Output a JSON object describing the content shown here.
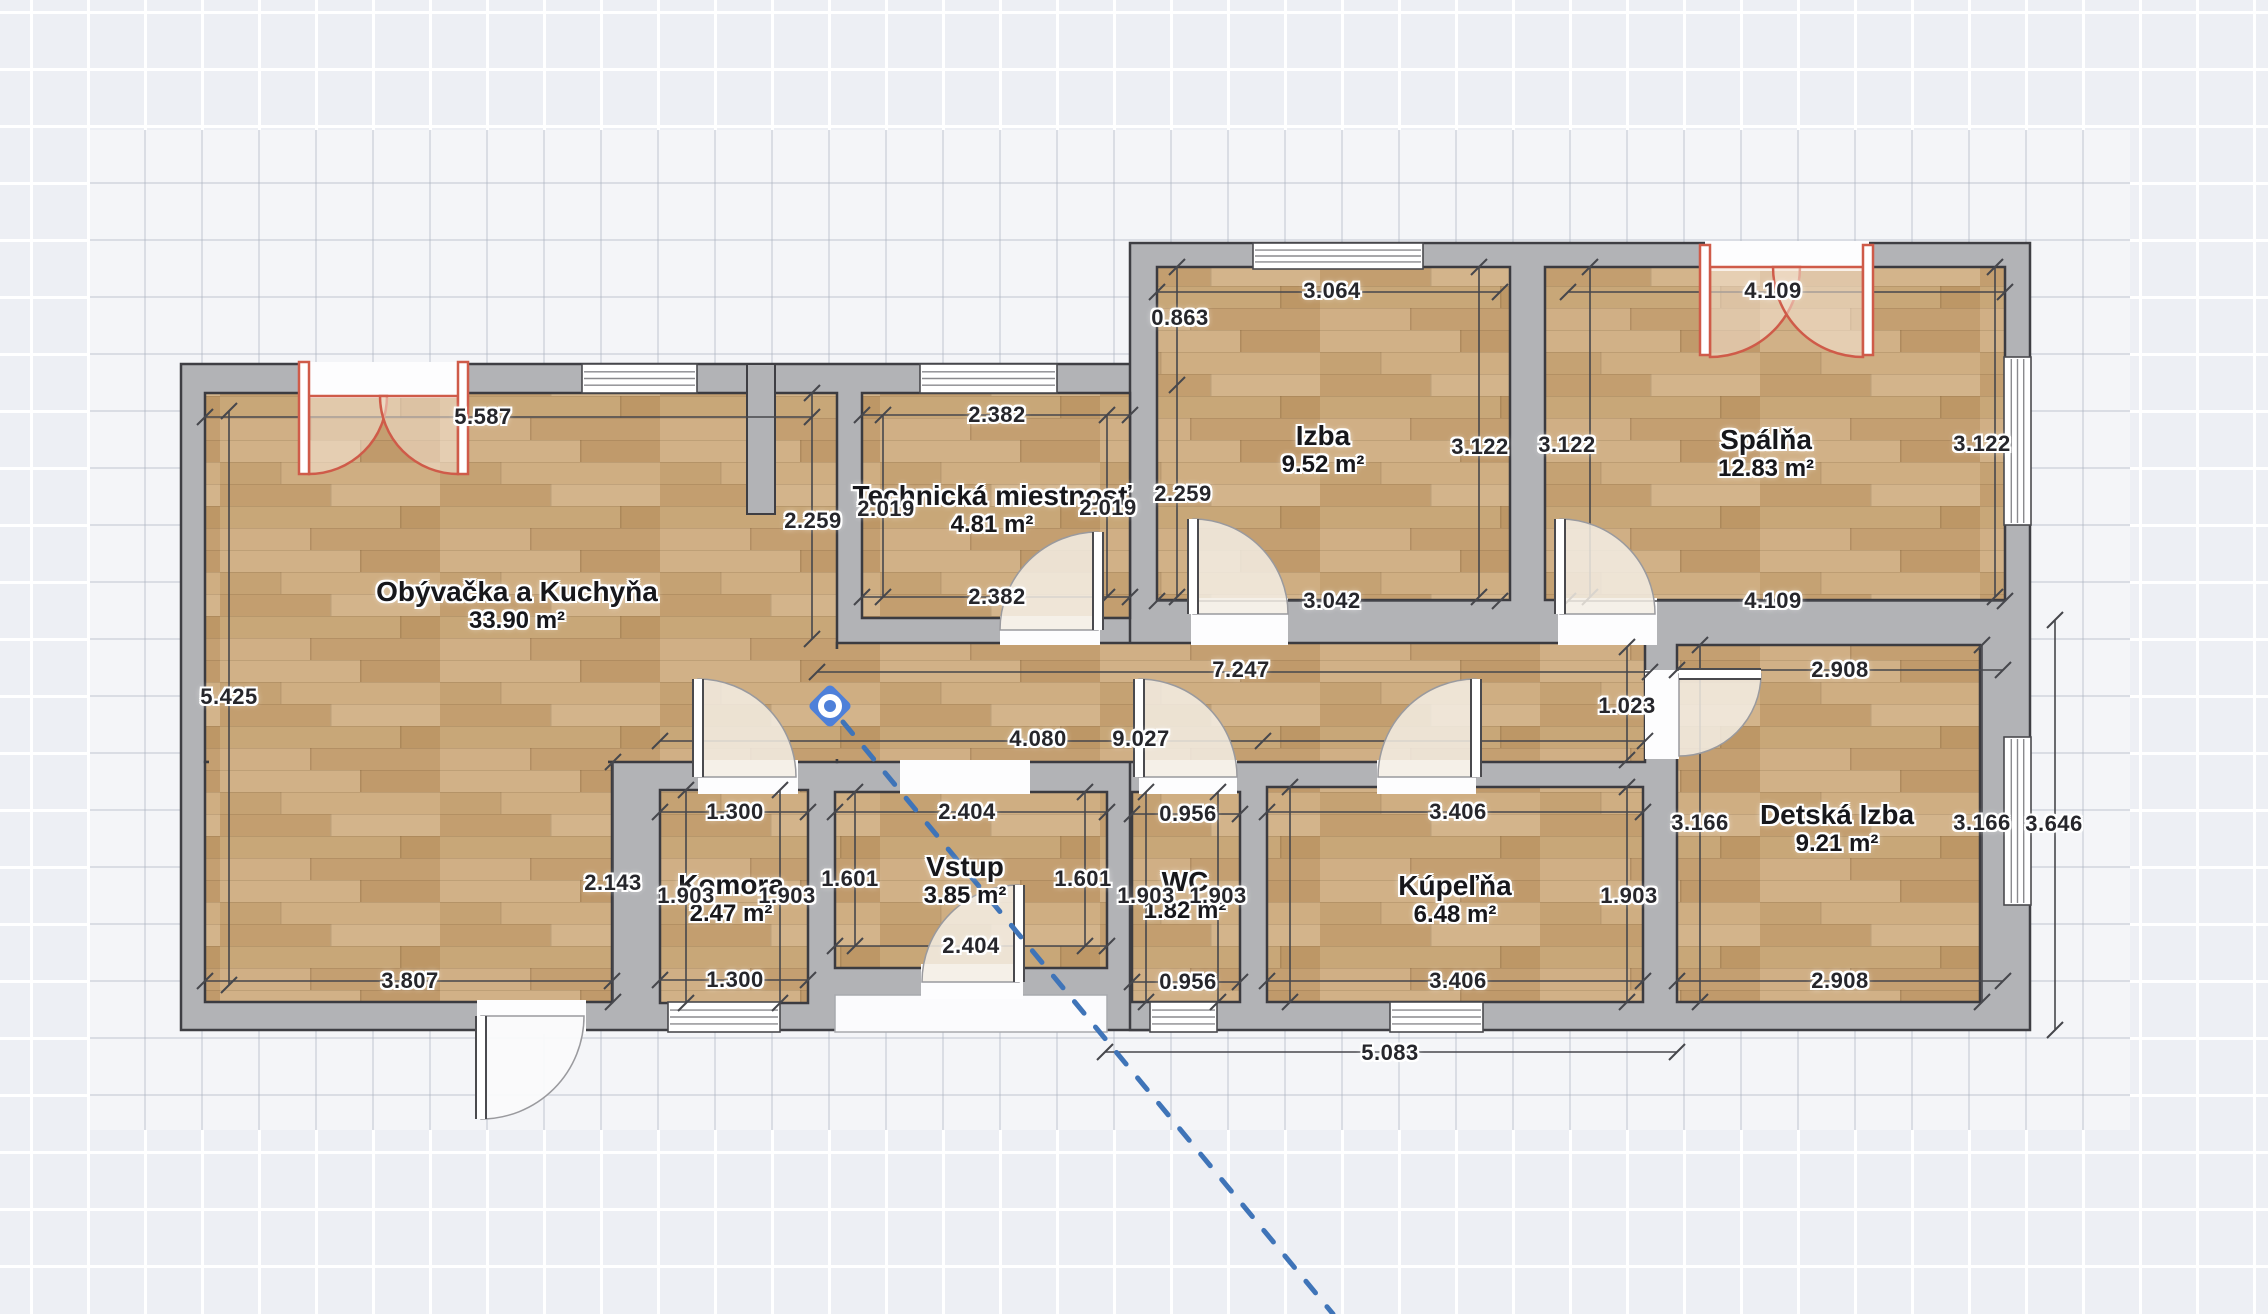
{
  "editor": {
    "selected_marker": "camera-viewpoint"
  },
  "colors": {
    "wall_fill": "#b2b3b6",
    "wall_edge": "#3e3e43",
    "floor_edge": "#3b3b40",
    "wood_base": "#c9a87b",
    "wood_planks": [
      "#d1b187",
      "#c09a6b",
      "#c5a273",
      "#cfae82",
      "#c39e6f",
      "#d3b48b",
      "#c8a778",
      "#bd9766",
      "#d0af85",
      "#c49f71"
    ],
    "dim_line": "#46474c",
    "red_door": "#cf5b49",
    "red_door_fill": "rgba(246,230,213,0.55)",
    "swing_fill": "rgba(243,237,228,0.85)",
    "ext_swing_fill": "rgba(250,250,251,0.95)",
    "dashed_line_blue": "#3f74b8",
    "opening_fill": "#fdfdfe",
    "porch_fill": "#fbfbfd",
    "porch_edge": "#a8a9ad",
    "camera_blue": "#4e80d9"
  },
  "rooms": [
    {
      "name": "Obývačka a Kuchyňa",
      "area": "33.90 m²",
      "label": [
        517,
        592
      ]
    },
    {
      "name": "Technická miestnosť",
      "area": "4.81 m²",
      "label": [
        992,
        496
      ]
    },
    {
      "name": "Izba",
      "area": "9.52 m²",
      "label": [
        1323,
        436
      ]
    },
    {
      "name": "Spálňa",
      "area": "12.83 m²",
      "label": [
        1766,
        440
      ]
    },
    {
      "name": "Komora",
      "area": "2.47 m²",
      "label": [
        731,
        885
      ]
    },
    {
      "name": "Vstup",
      "area": "3.85 m²",
      "label": [
        965,
        867
      ]
    },
    {
      "name": "WC",
      "area": "1.82 m²",
      "label": [
        1185,
        882
      ]
    },
    {
      "name": "Kúpeľňa",
      "area": "6.48 m²",
      "label": [
        1455,
        886
      ]
    },
    {
      "name": "Detská Izba",
      "area": "9.21 m²",
      "label": [
        1837,
        815
      ]
    }
  ],
  "walls": [
    {
      "id": "slab-left",
      "rect": [
        181,
        364,
        976,
        666
      ]
    },
    {
      "id": "slab-right",
      "rect": [
        1130,
        243,
        900,
        787
      ]
    }
  ],
  "wall_stub": [
    747,
    364,
    28,
    150
  ],
  "porch": [
    835,
    995,
    272,
    37
  ],
  "floors": [
    {
      "room": 0,
      "rect": [
        205,
        393,
        632,
        369
      ]
    },
    {
      "room": 0,
      "rect": [
        205,
        762,
        407,
        240
      ]
    },
    {
      "room": 0,
      "rect": [
        837,
        643,
        808,
        119
      ],
      "id": "corridor"
    },
    {
      "room": 1,
      "rect": [
        862,
        393,
        268,
        225
      ]
    },
    {
      "room": 2,
      "rect": [
        1157,
        267,
        353,
        333
      ]
    },
    {
      "room": 3,
      "rect": [
        1545,
        267,
        460,
        333
      ]
    },
    {
      "room": 8,
      "rect": [
        1677,
        645,
        303,
        357
      ]
    },
    {
      "room": 4,
      "rect": [
        660,
        790,
        148,
        213
      ]
    },
    {
      "room": 5,
      "rect": [
        835,
        792,
        272,
        176
      ]
    },
    {
      "room": 6,
      "rect": [
        1132,
        792,
        108,
        210
      ]
    },
    {
      "room": 7,
      "rect": [
        1267,
        787,
        376,
        215
      ]
    }
  ],
  "floor_patches": [
    [
      209,
      756,
      399,
      12
    ],
    [
      831,
      649,
      12,
      110
    ]
  ],
  "openings": [
    [
      698,
      760,
      100,
      34
    ],
    [
      900,
      760,
      130,
      34
    ],
    [
      1139,
      760,
      98,
      34
    ],
    [
      1377,
      760,
      99,
      34
    ],
    [
      1000,
      616,
      100,
      29
    ],
    [
      1191,
      598,
      97,
      47
    ],
    [
      1558,
      598,
      99,
      47
    ],
    [
      1645,
      670,
      34,
      89
    ],
    [
      921,
      964,
      102,
      35
    ],
    [
      477,
      1000,
      109,
      34
    ],
    [
      300,
      362,
      168,
      36
    ],
    [
      1705,
      241,
      164,
      30
    ]
  ],
  "windows": [
    {
      "id": "living-top",
      "rect": [
        582,
        364,
        115,
        29
      ],
      "v": false
    },
    {
      "id": "technical-top",
      "rect": [
        920,
        364,
        137,
        29
      ],
      "v": false
    },
    {
      "id": "izba-top",
      "rect": [
        1253,
        243,
        170,
        26
      ],
      "v": false
    },
    {
      "id": "spalna-right",
      "rect": [
        2004,
        357,
        27,
        168
      ],
      "v": true
    },
    {
      "id": "detska-right",
      "rect": [
        2004,
        737,
        27,
        168
      ],
      "v": true
    },
    {
      "id": "komora-bottom",
      "rect": [
        668,
        1002,
        112,
        30
      ],
      "v": false
    },
    {
      "id": "wc-bottom",
      "rect": [
        1150,
        1002,
        67,
        30
      ],
      "v": false
    },
    {
      "id": "kupelna-bottom",
      "rect": [
        1390,
        1002,
        93,
        30
      ],
      "v": false
    }
  ],
  "doors": [
    {
      "id": "door-komora",
      "hinge": [
        698,
        777
      ],
      "tip": [
        698,
        679
      ],
      "end": [
        796,
        777
      ],
      "r": 98,
      "sweep": 1,
      "ext": false
    },
    {
      "id": "door-wc",
      "hinge": [
        1139,
        777
      ],
      "tip": [
        1139,
        679
      ],
      "end": [
        1237,
        777
      ],
      "r": 98,
      "sweep": 1,
      "ext": false
    },
    {
      "id": "door-kupelna",
      "hinge": [
        1476,
        777
      ],
      "tip": [
        1476,
        679
      ],
      "end": [
        1378,
        777
      ],
      "r": 98,
      "sweep": 0,
      "ext": false
    },
    {
      "id": "door-technical",
      "hinge": [
        1098,
        630
      ],
      "tip": [
        1098,
        532
      ],
      "end": [
        1000,
        630
      ],
      "r": 98,
      "sweep": 0,
      "ext": false
    },
    {
      "id": "door-izba",
      "hinge": [
        1193,
        614
      ],
      "tip": [
        1193,
        519
      ],
      "end": [
        1288,
        614
      ],
      "r": 95,
      "sweep": 1,
      "ext": false
    },
    {
      "id": "door-spalna",
      "hinge": [
        1560,
        614
      ],
      "tip": [
        1560,
        519
      ],
      "end": [
        1655,
        614
      ],
      "r": 95,
      "sweep": 1,
      "ext": false
    },
    {
      "id": "door-detska",
      "hinge": [
        1679,
        674
      ],
      "tip": [
        1761,
        674
      ],
      "end": [
        1679,
        756
      ],
      "r": 82,
      "sweep": 1,
      "ext": false
    },
    {
      "id": "door-entry",
      "hinge": [
        1019,
        982
      ],
      "tip": [
        1019,
        885
      ],
      "end": [
        922,
        982
      ],
      "r": 97,
      "sweep": 0,
      "ext": false
    },
    {
      "id": "door-exterior",
      "hinge": [
        481,
        1016
      ],
      "tip": [
        481,
        1119
      ],
      "end": [
        584,
        1016
      ],
      "r": 103,
      "sweep": 0,
      "ext": true
    }
  ],
  "french_doors": [
    {
      "id": "french-living",
      "leaves": [
        [
          299,
          362,
          10,
          112
        ],
        [
          458,
          362,
          10,
          112
        ]
      ],
      "arcs": [
        {
          "hinge": [
            309,
            396
          ],
          "tip": [
            309,
            474
          ],
          "end": [
            387,
            396
          ],
          "r": 78,
          "sweep": 0
        },
        {
          "hinge": [
            458,
            396
          ],
          "tip": [
            458,
            474
          ],
          "end": [
            380,
            396
          ],
          "r": 78,
          "sweep": 1
        }
      ]
    },
    {
      "id": "french-spalna",
      "leaves": [
        [
          1700,
          245,
          10,
          110
        ],
        [
          1863,
          245,
          10,
          110
        ]
      ],
      "arcs": [
        {
          "hinge": [
            1710,
            267
          ],
          "tip": [
            1710,
            357
          ],
          "end": [
            1800,
            267
          ],
          "r": 90,
          "sweep": 0
        },
        {
          "hinge": [
            1863,
            267
          ],
          "tip": [
            1863,
            357
          ],
          "end": [
            1773,
            267
          ],
          "r": 90,
          "sweep": 1
        }
      ]
    }
  ],
  "dim_lines": [
    [
      205,
      417,
      812,
      417
    ],
    [
      862,
      415,
      1130,
      415
    ],
    [
      1157,
      292,
      1500,
      292
    ],
    [
      1568,
      292,
      2005,
      292
    ],
    [
      862,
      597,
      1130,
      597
    ],
    [
      1157,
      601,
      1500,
      601
    ],
    [
      1568,
      601,
      2005,
      601
    ],
    [
      817,
      672,
      1650,
      672
    ],
    [
      1677,
      670,
      2003,
      670
    ],
    [
      660,
      741,
      1645,
      741
    ],
    [
      660,
      812,
      808,
      812
    ],
    [
      835,
      812,
      1107,
      812
    ],
    [
      1132,
      814,
      1240,
      814
    ],
    [
      1267,
      812,
      1643,
      812
    ],
    [
      835,
      946,
      1107,
      946
    ],
    [
      205,
      981,
      612,
      981
    ],
    [
      660,
      980,
      808,
      980
    ],
    [
      1132,
      982,
      1240,
      982
    ],
    [
      1267,
      981,
      1643,
      981
    ],
    [
      1677,
      981,
      2003,
      981
    ],
    [
      1105,
      1052,
      1677,
      1052
    ],
    [
      229,
      411,
      229,
      985
    ],
    [
      812,
      393,
      812,
      639
    ],
    [
      883,
      415,
      883,
      597
    ],
    [
      1107,
      415,
      1107,
      597
    ],
    [
      1177,
      267,
      1177,
      597
    ],
    [
      1479,
      267,
      1479,
      597
    ],
    [
      1590,
      267,
      1590,
      597
    ],
    [
      1995,
      267,
      1995,
      597
    ],
    [
      613,
      762,
      613,
      1002
    ],
    [
      686,
      790,
      686,
      1003
    ],
    [
      780,
      790,
      780,
      1003
    ],
    [
      855,
      792,
      855,
      946
    ],
    [
      1085,
      792,
      1085,
      946
    ],
    [
      1146,
      792,
      1146,
      1002
    ],
    [
      1218,
      792,
      1218,
      1002
    ],
    [
      1290,
      787,
      1290,
      1002
    ],
    [
      1627,
      647,
      1627,
      760
    ],
    [
      1627,
      787,
      1627,
      1002
    ],
    [
      1700,
      645,
      1700,
      1002
    ],
    [
      1982,
      645,
      1982,
      1002
    ],
    [
      2055,
      620,
      2055,
      1030
    ]
  ],
  "extra_ticks": [
    [
      1263,
      741
    ],
    [
      1177,
      385
    ]
  ],
  "dimensions": [
    {
      "text": "5.587",
      "pos": [
        483,
        417
      ]
    },
    {
      "text": "2.382",
      "pos": [
        997,
        415
      ]
    },
    {
      "text": "3.064",
      "pos": [
        1332,
        291
      ]
    },
    {
      "text": "4.109",
      "pos": [
        1773,
        291
      ]
    },
    {
      "text": "0.863",
      "pos": [
        1180,
        318
      ]
    },
    {
      "text": "2.259",
      "pos": [
        813,
        521
      ]
    },
    {
      "text": "2.019",
      "pos": [
        886,
        509
      ]
    },
    {
      "text": "2.019",
      "pos": [
        1108,
        508
      ]
    },
    {
      "text": "2.259",
      "pos": [
        1183,
        494
      ]
    },
    {
      "text": "3.122",
      "pos": [
        1480,
        447
      ]
    },
    {
      "text": "3.122",
      "pos": [
        1567,
        445
      ]
    },
    {
      "text": "3.122",
      "pos": [
        1982,
        444
      ]
    },
    {
      "text": "2.382",
      "pos": [
        997,
        597
      ]
    },
    {
      "text": "3.042",
      "pos": [
        1332,
        601
      ]
    },
    {
      "text": "4.109",
      "pos": [
        1773,
        601
      ]
    },
    {
      "text": "5.425",
      "pos": [
        229,
        697
      ]
    },
    {
      "text": "7.247",
      "pos": [
        1241,
        670
      ]
    },
    {
      "text": "2.908",
      "pos": [
        1840,
        670
      ]
    },
    {
      "text": "4.080",
      "pos": [
        1038,
        739
      ]
    },
    {
      "text": "9.027",
      "pos": [
        1141,
        739
      ]
    },
    {
      "text": "1.023",
      "pos": [
        1627,
        706
      ]
    },
    {
      "text": "1.300",
      "pos": [
        735,
        812
      ]
    },
    {
      "text": "2.404",
      "pos": [
        967,
        812
      ]
    },
    {
      "text": "0.956",
      "pos": [
        1188,
        814
      ]
    },
    {
      "text": "3.406",
      "pos": [
        1458,
        812
      ]
    },
    {
      "text": "3.166",
      "pos": [
        1700,
        823
      ]
    },
    {
      "text": "3.166",
      "pos": [
        1982,
        823
      ]
    },
    {
      "text": "3.646",
      "pos": [
        2054,
        824
      ]
    },
    {
      "text": "2.143",
      "pos": [
        613,
        883
      ]
    },
    {
      "text": "1.903",
      "pos": [
        686,
        896
      ]
    },
    {
      "text": "1.903",
      "pos": [
        787,
        896
      ]
    },
    {
      "text": "1.601",
      "pos": [
        850,
        879
      ]
    },
    {
      "text": "1.601",
      "pos": [
        1083,
        879
      ]
    },
    {
      "text": "1.903",
      "pos": [
        1146,
        896
      ]
    },
    {
      "text": "1.903",
      "pos": [
        1218,
        896
      ]
    },
    {
      "text": "1.903",
      "pos": [
        1629,
        896
      ]
    },
    {
      "text": "2.404",
      "pos": [
        971,
        946
      ]
    },
    {
      "text": "3.807",
      "pos": [
        410,
        981
      ]
    },
    {
      "text": "1.300",
      "pos": [
        735,
        980
      ]
    },
    {
      "text": "0.956",
      "pos": [
        1188,
        982
      ]
    },
    {
      "text": "3.406",
      "pos": [
        1458,
        981
      ]
    },
    {
      "text": "2.908",
      "pos": [
        1840,
        981
      ]
    },
    {
      "text": "5.083",
      "pos": [
        1390,
        1053
      ]
    }
  ],
  "camera": {
    "x": 830,
    "y": 706
  },
  "dashed_line": {
    "x1": 843,
    "y1": 722,
    "x2": 1333,
    "y2": 1314
  }
}
